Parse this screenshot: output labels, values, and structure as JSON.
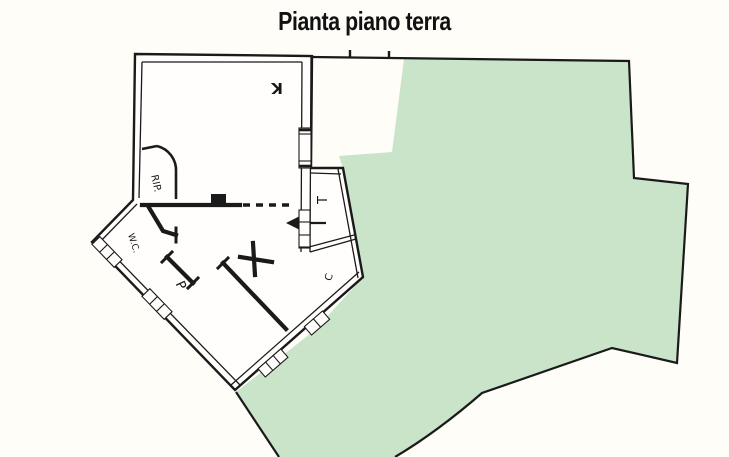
{
  "title": "Pianta piano terra",
  "floorplan": {
    "rooms": {
      "kitchen_label": "K",
      "storage_label": "RIP.",
      "wc_label": "W.C.",
      "bedroom_label": "P",
      "terrace_label": "T",
      "corridor_label": "C"
    },
    "garden": {
      "description": "garden-area"
    }
  },
  "colors": {
    "garden_fill": "#c9e4c9",
    "plan_lines": "#1a1a1a",
    "background": "#fffdf8"
  }
}
